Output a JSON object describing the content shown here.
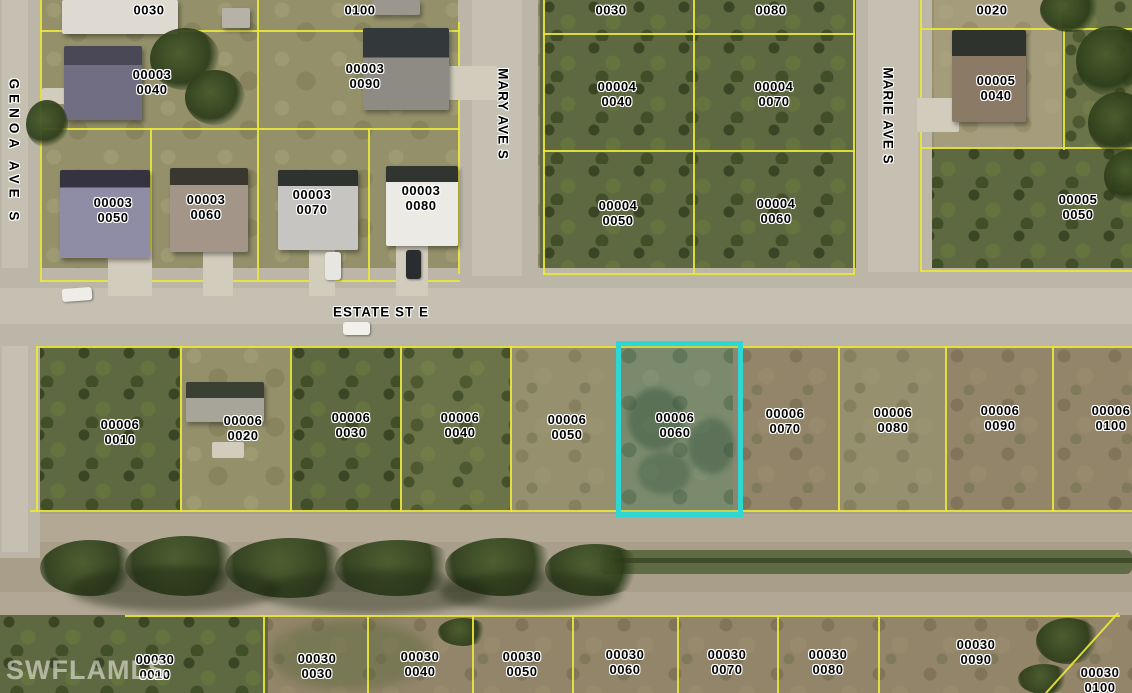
{
  "watermark": "SWFLAMLS",
  "highlight": {
    "parcel": "00006 0060",
    "color": "#2ed7d3"
  },
  "line_color": "#e9e63d",
  "street_labels": [
    {
      "name": "GENOA AVE S",
      "x": 14,
      "y": 152,
      "vertical": true,
      "spread": true
    },
    {
      "name": "MARY AVE S",
      "x": 503,
      "y": 114,
      "vertical": true,
      "spread": false
    },
    {
      "name": "MARIE AVE S",
      "x": 888,
      "y": 116,
      "vertical": true,
      "spread": false
    },
    {
      "name": "ESTATE ST E",
      "x": 381,
      "y": 312,
      "vertical": false,
      "spread": false
    }
  ],
  "parcel_labels": [
    {
      "lines": [
        "0030"
      ],
      "x": 149,
      "y": 10
    },
    {
      "lines": [
        "0100"
      ],
      "x": 360,
      "y": 10
    },
    {
      "lines": [
        "0030"
      ],
      "x": 611,
      "y": 10
    },
    {
      "lines": [
        "0080"
      ],
      "x": 771,
      "y": 10
    },
    {
      "lines": [
        "0020"
      ],
      "x": 992,
      "y": 10
    },
    {
      "lines": [
        "00003",
        "0040"
      ],
      "x": 152,
      "y": 82
    },
    {
      "lines": [
        "00003",
        "0090"
      ],
      "x": 365,
      "y": 76
    },
    {
      "lines": [
        "00004",
        "0040"
      ],
      "x": 617,
      "y": 94
    },
    {
      "lines": [
        "00004",
        "0070"
      ],
      "x": 774,
      "y": 94
    },
    {
      "lines": [
        "00005",
        "0040"
      ],
      "x": 996,
      "y": 88
    },
    {
      "lines": [
        "00003",
        "0050"
      ],
      "x": 113,
      "y": 210
    },
    {
      "lines": [
        "00003",
        "0060"
      ],
      "x": 206,
      "y": 207
    },
    {
      "lines": [
        "00003",
        "0070"
      ],
      "x": 312,
      "y": 202
    },
    {
      "lines": [
        "00003",
        "0080"
      ],
      "x": 421,
      "y": 198
    },
    {
      "lines": [
        "00004",
        "0050"
      ],
      "x": 618,
      "y": 213
    },
    {
      "lines": [
        "00004",
        "0060"
      ],
      "x": 776,
      "y": 211
    },
    {
      "lines": [
        "00005",
        "0050"
      ],
      "x": 1078,
      "y": 207
    },
    {
      "lines": [
        "00006",
        "0010"
      ],
      "x": 120,
      "y": 432
    },
    {
      "lines": [
        "00006",
        "0020"
      ],
      "x": 243,
      "y": 428
    },
    {
      "lines": [
        "00006",
        "0030"
      ],
      "x": 351,
      "y": 425
    },
    {
      "lines": [
        "00006",
        "0040"
      ],
      "x": 460,
      "y": 425
    },
    {
      "lines": [
        "00006",
        "0050"
      ],
      "x": 567,
      "y": 427
    },
    {
      "lines": [
        "00006",
        "0060"
      ],
      "x": 675,
      "y": 425
    },
    {
      "lines": [
        "00006",
        "0070"
      ],
      "x": 785,
      "y": 421
    },
    {
      "lines": [
        "00006",
        "0080"
      ],
      "x": 893,
      "y": 420
    },
    {
      "lines": [
        "00006",
        "0090"
      ],
      "x": 1000,
      "y": 418
    },
    {
      "lines": [
        "00006",
        "0100"
      ],
      "x": 1111,
      "y": 418
    },
    {
      "lines": [
        "00030",
        "0010"
      ],
      "x": 155,
      "y": 667
    },
    {
      "lines": [
        "00030",
        "0030"
      ],
      "x": 317,
      "y": 666
    },
    {
      "lines": [
        "00030",
        "0040"
      ],
      "x": 420,
      "y": 664
    },
    {
      "lines": [
        "00030",
        "0050"
      ],
      "x": 522,
      "y": 664
    },
    {
      "lines": [
        "00030",
        "0060"
      ],
      "x": 625,
      "y": 662
    },
    {
      "lines": [
        "00030",
        "0070"
      ],
      "x": 727,
      "y": 662
    },
    {
      "lines": [
        "00030",
        "0080"
      ],
      "x": 828,
      "y": 662
    },
    {
      "lines": [
        "00030",
        "0090"
      ],
      "x": 976,
      "y": 652
    },
    {
      "lines": [
        "00030",
        "0100"
      ],
      "x": 1100,
      "y": 680
    }
  ]
}
